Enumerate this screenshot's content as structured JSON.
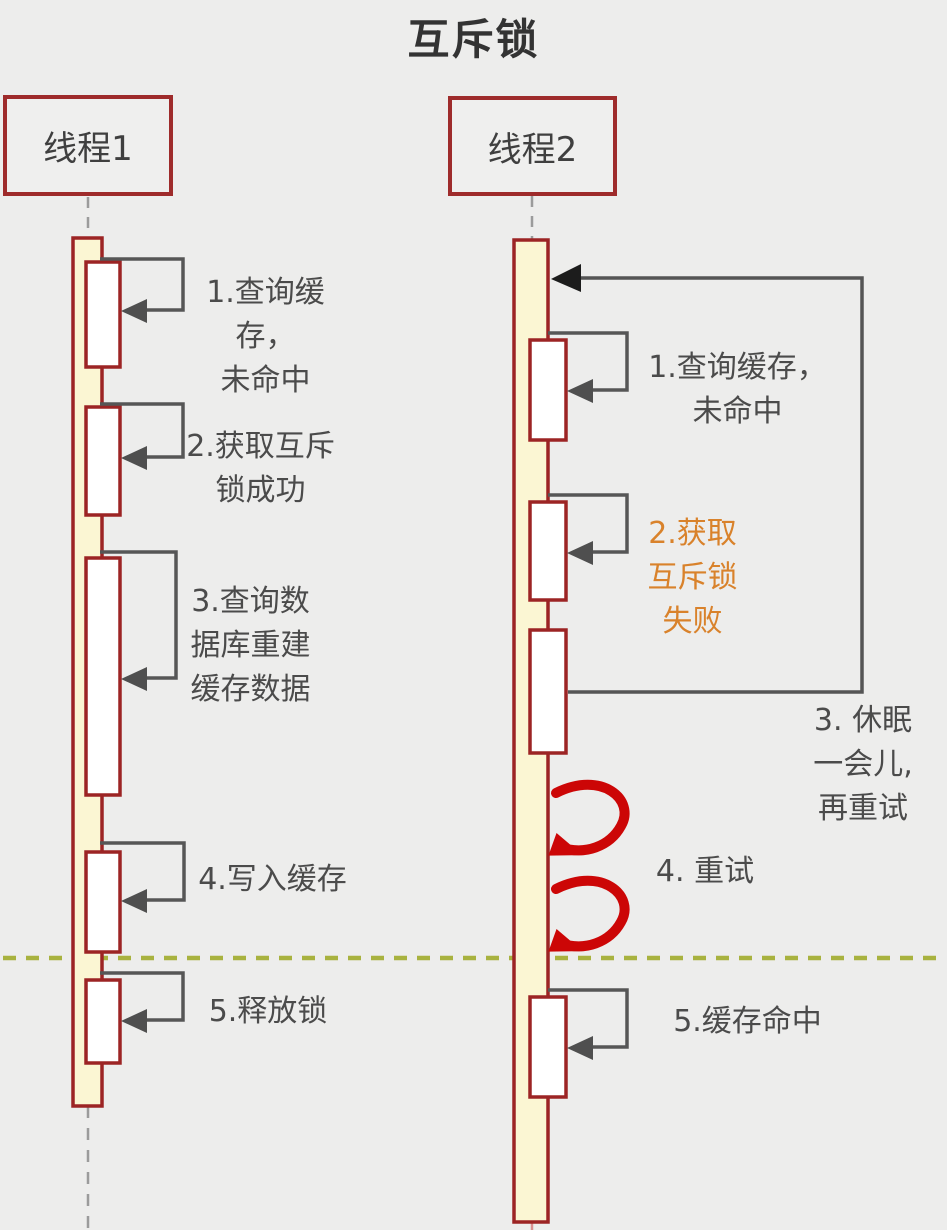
{
  "title": "互斥锁",
  "threads": [
    {
      "name": "线程1",
      "steps": [
        {
          "label": "1.查询缓存，\n未命中"
        },
        {
          "label": "2.获取互斥\n锁成功"
        },
        {
          "label": "3.查询数\n据库重建\n缓存数据"
        },
        {
          "label": "4.写入缓存"
        },
        {
          "label": "5.释放锁"
        }
      ]
    },
    {
      "name": "线程2",
      "steps": [
        {
          "label": "1.查询缓存，\n未命中"
        },
        {
          "label": "2.获取\n互斥锁\n失败"
        },
        {
          "label": "3. 休眠\n一会儿,\n再重试"
        },
        {
          "label": "4. 重试"
        },
        {
          "label": "5.缓存命中"
        }
      ]
    }
  ],
  "colors": {
    "background": "#ededec",
    "box_border": "#9e2b2b",
    "activation_fill": "#fbf6d3",
    "activation_border": "#9c2424",
    "step_fill": "#ffffff",
    "self_call_line": "#565656",
    "retry_loop_line": "#555555",
    "retry_loop_arrowhead": "#1c1c1c",
    "retry_spiral_red": "#cc0606",
    "fail_text_orange": "#d9822b",
    "label_text": "#4b4b4b",
    "lifeline_dash": "#9b9b9b",
    "timeline_divider_olive": "#a8b23f"
  }
}
